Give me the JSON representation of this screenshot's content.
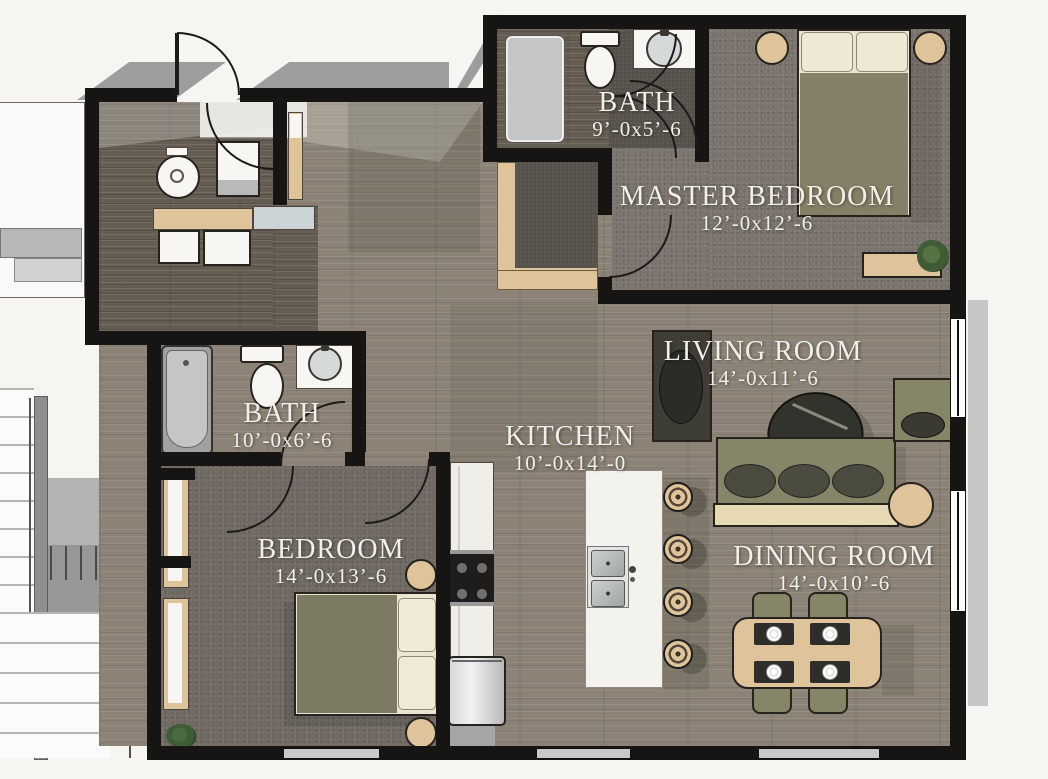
{
  "palette": {
    "bg": "#f7f5f1",
    "wall": "#171513",
    "wood": "#8c8376",
    "wood_dark": "#655c52",
    "carpet_master": "#7b746d",
    "carpet_bedroom": "#6f6962",
    "carpet_closet": "#56514b",
    "tan": "#dfc39b",
    "olive": "#878568",
    "olive_dark": "#4b4b40",
    "cream": "#ebe4d1",
    "fixture_white": "#f7f6f3",
    "fixture_gray": "#c3c6c5",
    "steel_light": "#e9e9e9",
    "steel_dark": "#adadad",
    "concrete": "#9d9d9d",
    "concrete_light": "#c6c6c6",
    "label": "#f2efe9",
    "plant_green": "#3f5c36",
    "beanbag": "#33332e"
  },
  "rooms": [
    {
      "id": "bath-top",
      "name": "BATH",
      "dims": "9’-0x5’-6"
    },
    {
      "id": "master-bedroom",
      "name": "MASTER BEDROOM",
      "dims": "12’-0x12’-6"
    },
    {
      "id": "living-room",
      "name": "LIVING ROOM",
      "dims": "14’-0x11’-6"
    },
    {
      "id": "bath-left",
      "name": "BATH",
      "dims": "10’-0x6’-6"
    },
    {
      "id": "kitchen",
      "name": "KITCHEN",
      "dims": "10’-0x14’-0"
    },
    {
      "id": "bedroom",
      "name": "BEDROOM",
      "dims": "14’-0x13’-6"
    },
    {
      "id": "dining-room",
      "name": "DINING ROOM",
      "dims": "14’-0x10’-6"
    }
  ]
}
